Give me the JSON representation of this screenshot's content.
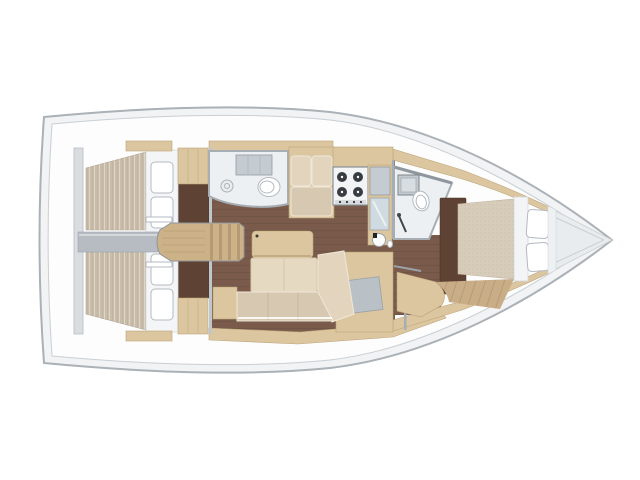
{
  "canvas": {
    "width": 640,
    "height": 480
  },
  "diagram": {
    "kind": "sailing-yacht interior floor plan, top-down view",
    "bow_side": "right",
    "stern_side": "left"
  },
  "colors": {
    "page_bg": "#ffffff",
    "hull_line": "#aab1b7",
    "hull_side": "#f1f3f4",
    "deck": "#fdfdfe",
    "deck_line": "#c9cfd3",
    "bow_platform": "#e8ecef",
    "wall": "#a6adb3",
    "wall_light": "#d9dde0",
    "salon_floor": "#7a5b4b",
    "dark_floor": "#5e4233",
    "fwd_floor": "#c9ad87",
    "wood": "#dcc6a0",
    "wood_edge": "#bda47a",
    "steps": "#cdb287",
    "mattress_aft": "#c9bca9",
    "mattress_fwd": "#d7ccb9",
    "cushion": "#e2d4bd",
    "cushion_seat": "#d7c8b2",
    "white_fixture": "#ffffff",
    "fixture_line": "#b3bac1",
    "counter": "#c4cbd1",
    "gray_panel": "#b9c0c6",
    "engine_box": "#b6bcc2",
    "glass": "#cfdbe0",
    "stove_top": "#f2f4f5",
    "burner": "#383d42",
    "bath_floor": "#edf0f2"
  },
  "inventory": {
    "hull": [
      "bow",
      "stern-transom",
      "side-decks",
      "bow-platform"
    ],
    "aft_cabin_port": [
      "double-berth",
      "pillows-2",
      "wardrobe",
      "shelf"
    ],
    "aft_cabin_starboard": [
      "double-berth",
      "pillows-2",
      "wardrobe",
      "shelf"
    ],
    "companionway": [
      "steps",
      "engine-compartment",
      "sliding-hatch-rails"
    ],
    "aft_head": [
      "washbasin",
      "toilet",
      "shower-locker"
    ],
    "salon": [
      "table",
      "l-shaped-sofa",
      "settee-2-seats",
      "side-cabinet"
    ],
    "galley": [
      "stove-4-burners",
      "counter",
      "fridge",
      "round-sink"
    ],
    "nav_station": [
      "chart-table"
    ],
    "forward_head": [
      "washbasin",
      "toilet",
      "shower"
    ],
    "forward_cabin": [
      "island-berth",
      "pillows-2",
      "dark-wardrobe",
      "bench",
      "cabin-door"
    ]
  }
}
